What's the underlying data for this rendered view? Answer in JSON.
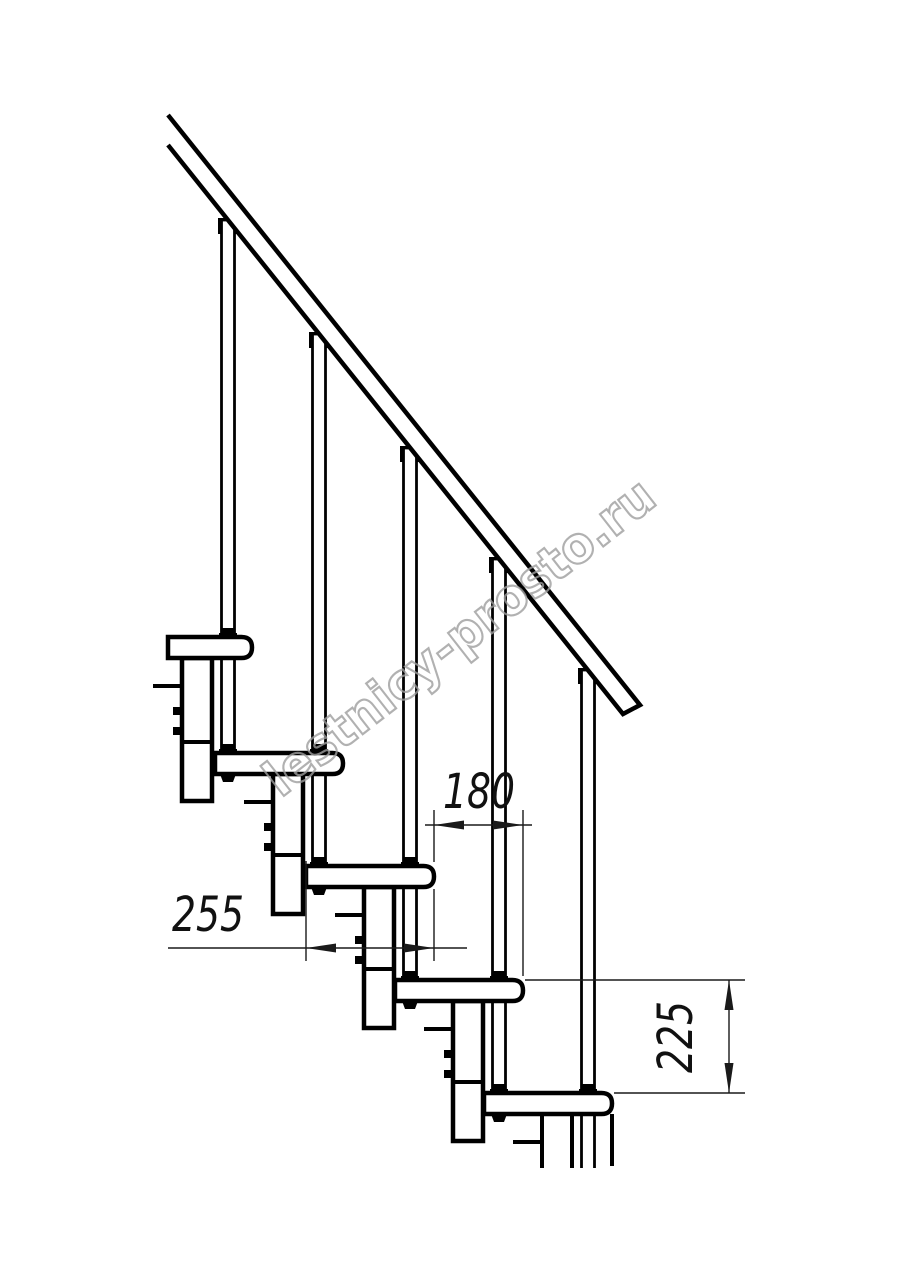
{
  "watermark": {
    "text": "lestnicy-prosto.ru"
  },
  "dimensions": {
    "step_run": {
      "value": "180",
      "orientation": "horizontal"
    },
    "tread_depth": {
      "value": "255",
      "orientation": "horizontal"
    },
    "riser_height": {
      "value": "225",
      "orientation": "vertical"
    }
  }
}
